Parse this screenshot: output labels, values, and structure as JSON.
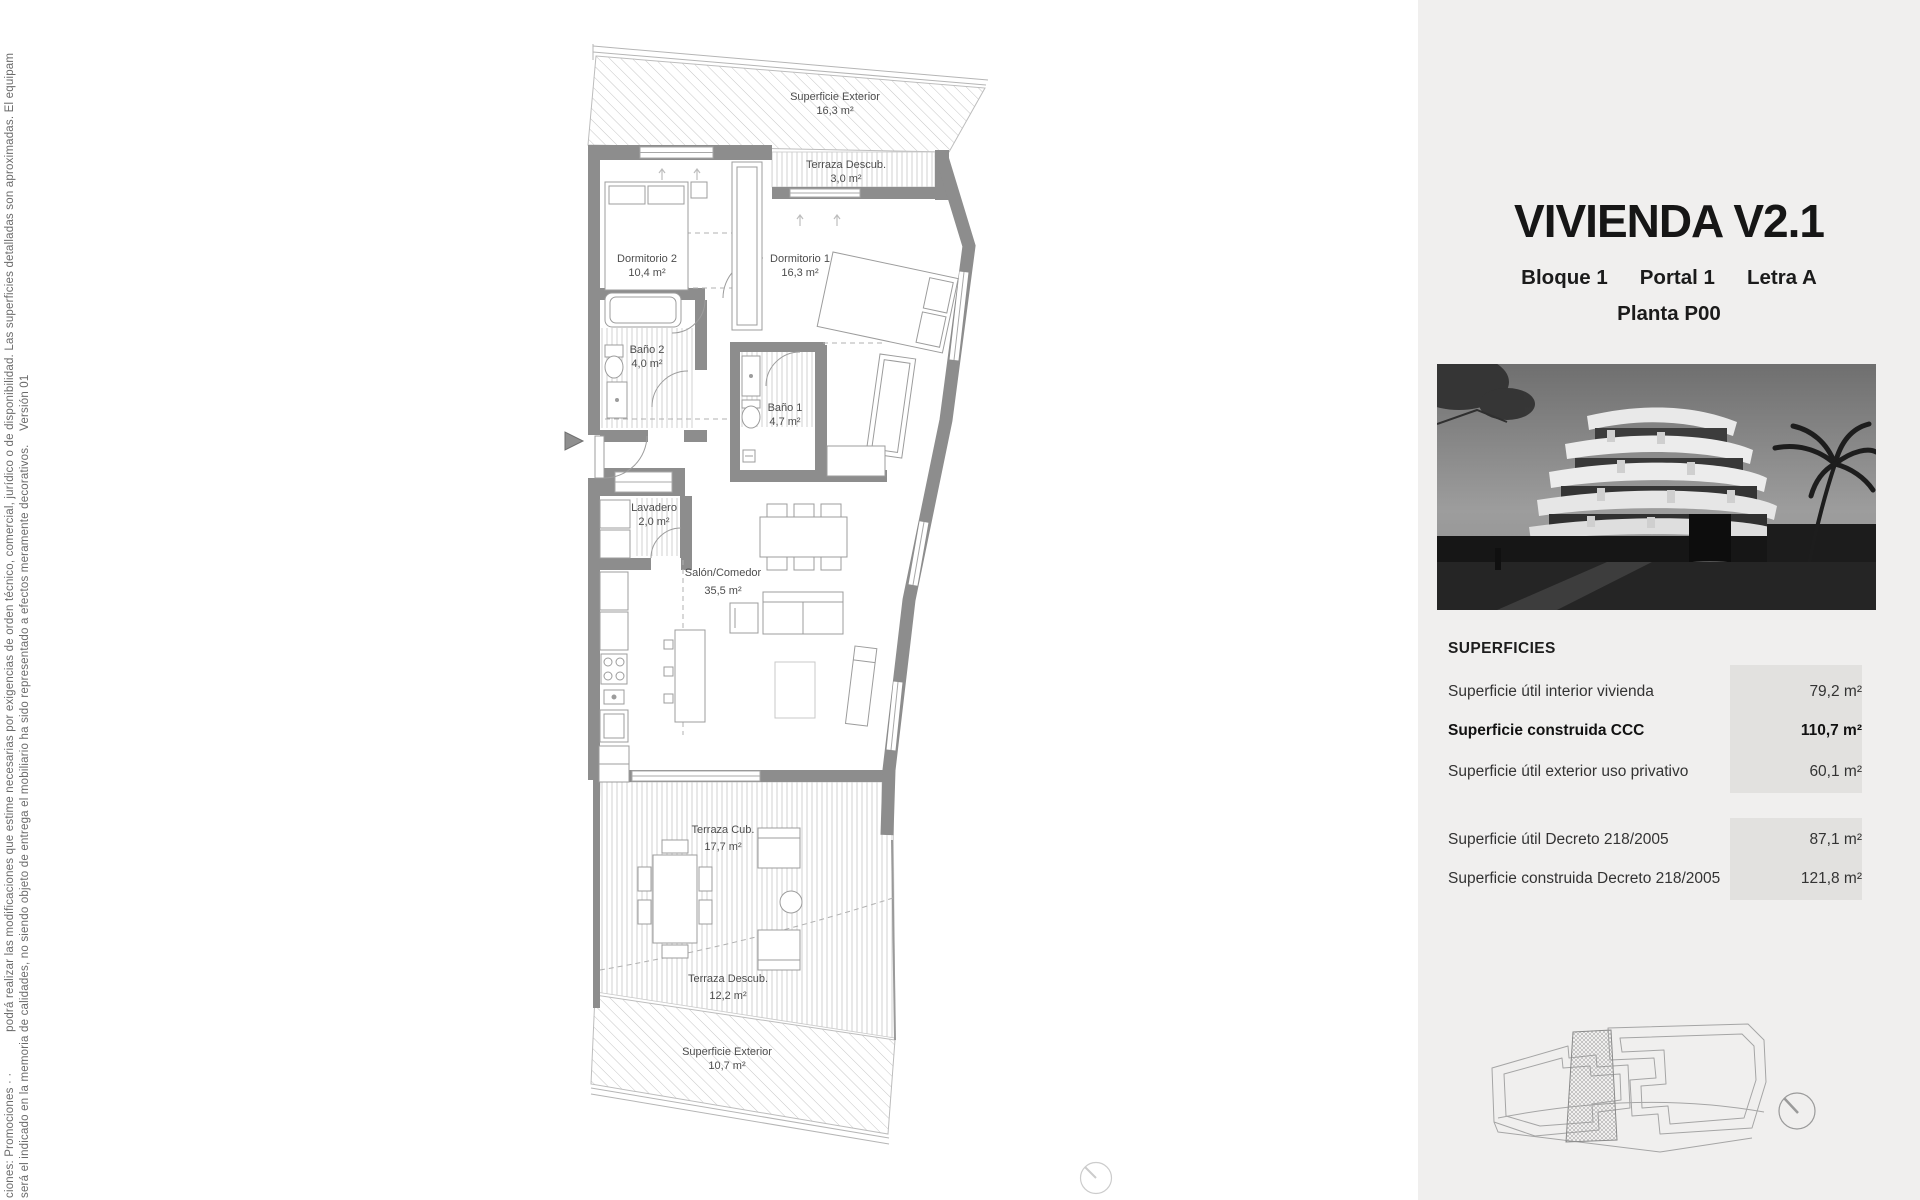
{
  "left_disclaimer": {
    "line1": "ciones: Promociones · ·            podrá realizar las modificaciones que estime necesarias por exigencias de orden técnico, comercial, jurídico o de disponibilidad. Las superficies detalladas son aproximadas. El equipam",
    "line2": "será el indicado en la memoria de calidades, no siendo objeto de entrega el mobiliario ha sido representado a efectos meramente decorativos.    Versión 01"
  },
  "panel": {
    "title": "VIVIENDA V2.1",
    "subtitle": {
      "bloque": "Bloque 1",
      "portal": "Portal 1",
      "letra": "Letra A",
      "planta": "Planta P00"
    },
    "superficies": {
      "heading": "SUPERFICIES",
      "rows_main": [
        {
          "label": "Superficie útil interior vivienda",
          "value": "79,2 m²"
        },
        {
          "label": "Superficie construida CCC",
          "value": "110,7 m²"
        },
        {
          "label": "Superficie útil exterior uso privativo",
          "value": "60,1 m²"
        }
      ],
      "rows_decreto": [
        {
          "label": "Superficie útil Decreto 218/2005",
          "value": "87,1 m²"
        },
        {
          "label": "Superficie construida Decreto 218/2005",
          "value": "121,8 m²"
        }
      ]
    }
  },
  "floor_plan": {
    "rooms": [
      {
        "name": "Superficie Exterior",
        "area": "16,3 m²"
      },
      {
        "name": "Terraza Descub.",
        "area": "3,0 m²"
      },
      {
        "name": "Dormitorio 2",
        "area": "10,4 m²"
      },
      {
        "name": "Dormitorio 1",
        "area": "16,3 m²"
      },
      {
        "name": "Baño 2",
        "area": "4,0 m²"
      },
      {
        "name": "Baño 1",
        "area": "4,7 m²"
      },
      {
        "name": "Lavadero",
        "area": "2,0 m²"
      },
      {
        "name": "Salón/Comedor",
        "area": "35,5 m²"
      },
      {
        "name": "Terraza Cub.",
        "area": "17,7 m²"
      },
      {
        "name": "Terraza Descub.",
        "area": "12,2 m²"
      },
      {
        "name": "Superficie Exterior",
        "area": "10,7 m²"
      }
    ]
  },
  "colors": {
    "panel_bg": "#f0efee",
    "cell_bg": "#e2e1df",
    "wall_gray": "#8d8d8d",
    "line_gray": "#9c9c9c",
    "text_dark": "#161616"
  }
}
